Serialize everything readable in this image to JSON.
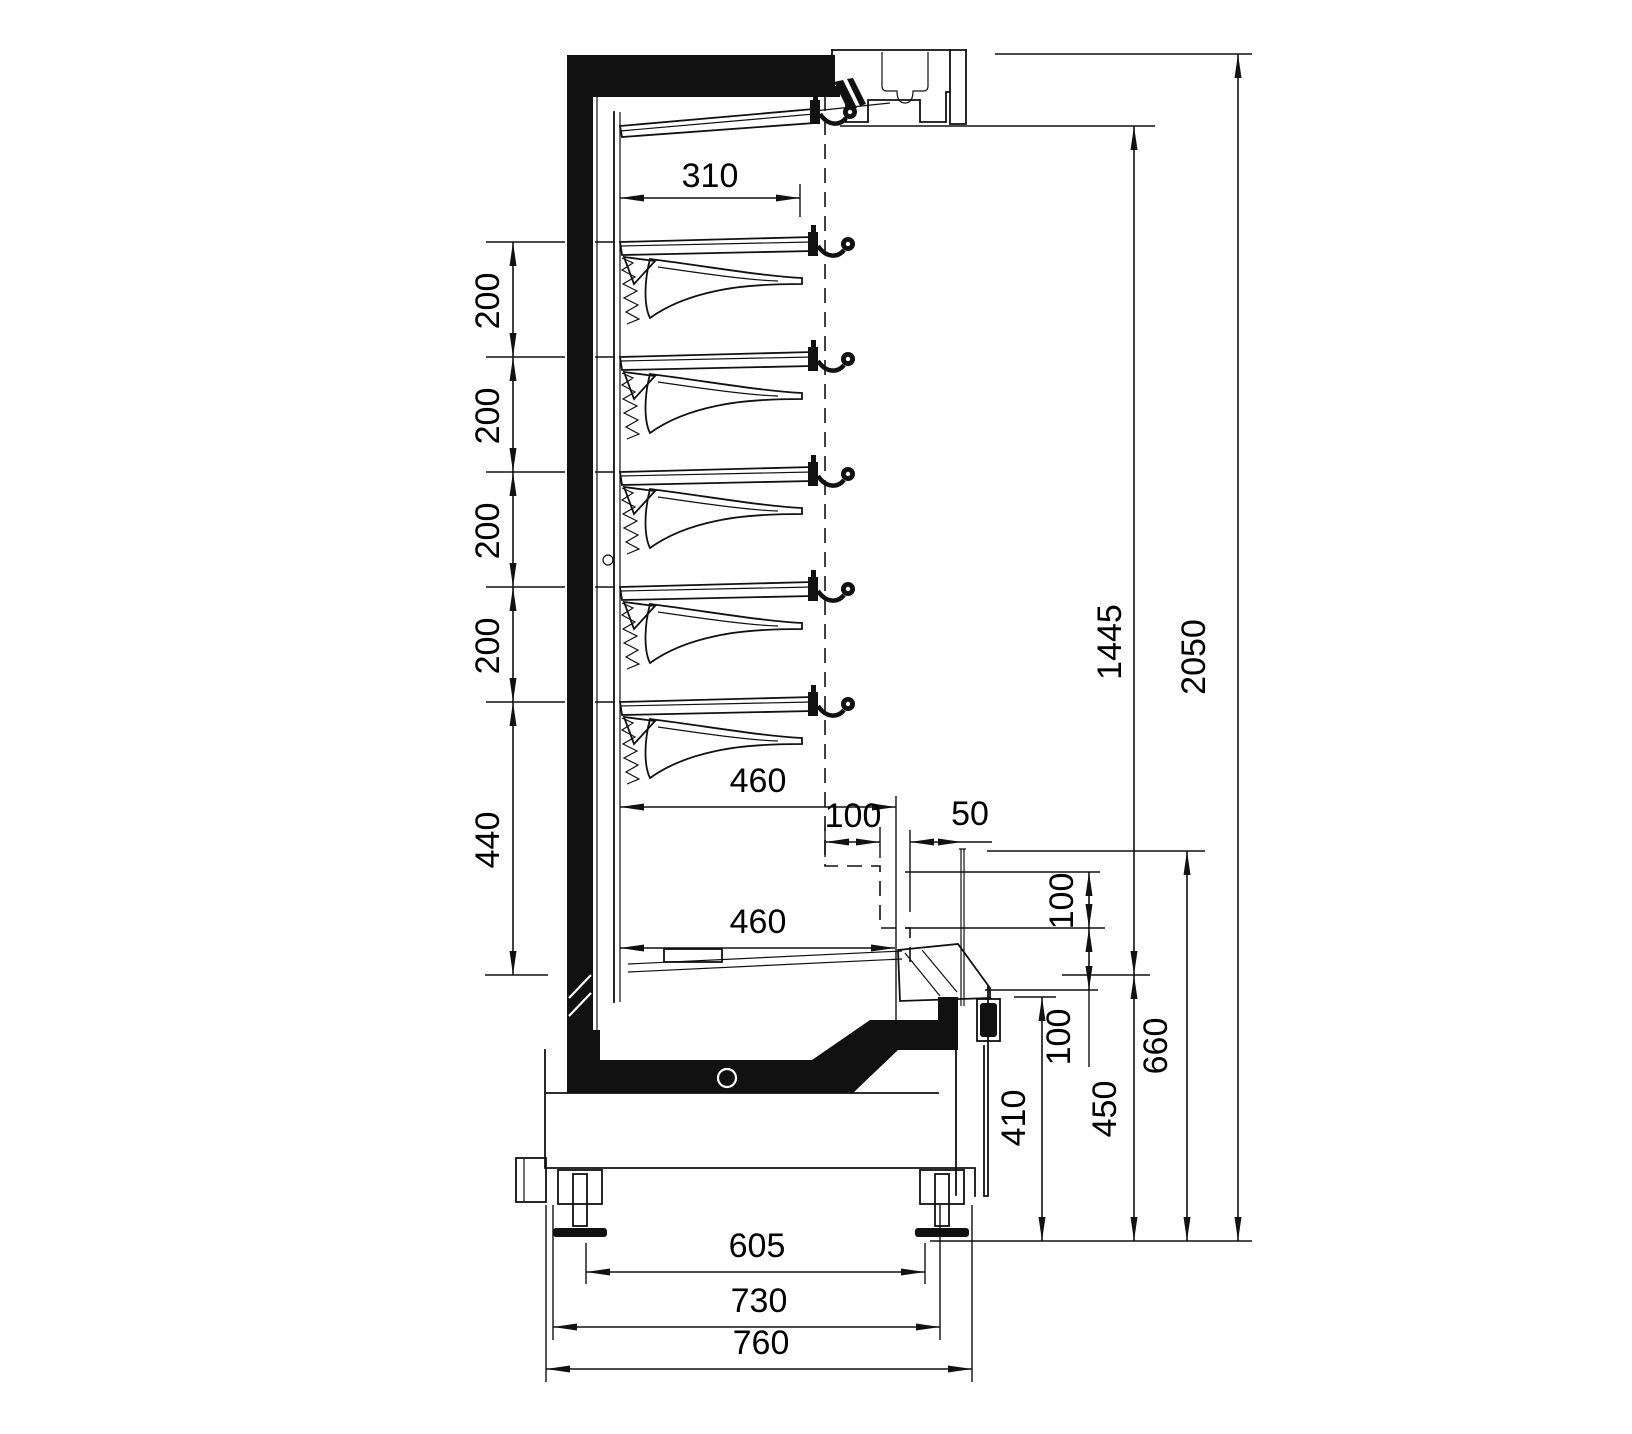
{
  "drawing": {
    "type": "cross-section technical drawing",
    "dims": {
      "d310": "310",
      "d200_1": "200",
      "d200_2": "200",
      "d200_3": "200",
      "d200_4": "200",
      "d440": "440",
      "d460_upper": "460",
      "d100_step": "100",
      "d50": "50",
      "d460_lower": "460",
      "d100_right_upper": "100",
      "d100_right_lower": "100",
      "d1445": "1445",
      "d2050": "2050",
      "d410": "410",
      "d450": "450",
      "d660": "660",
      "d605": "605",
      "d730": "730",
      "d760": "760"
    }
  }
}
